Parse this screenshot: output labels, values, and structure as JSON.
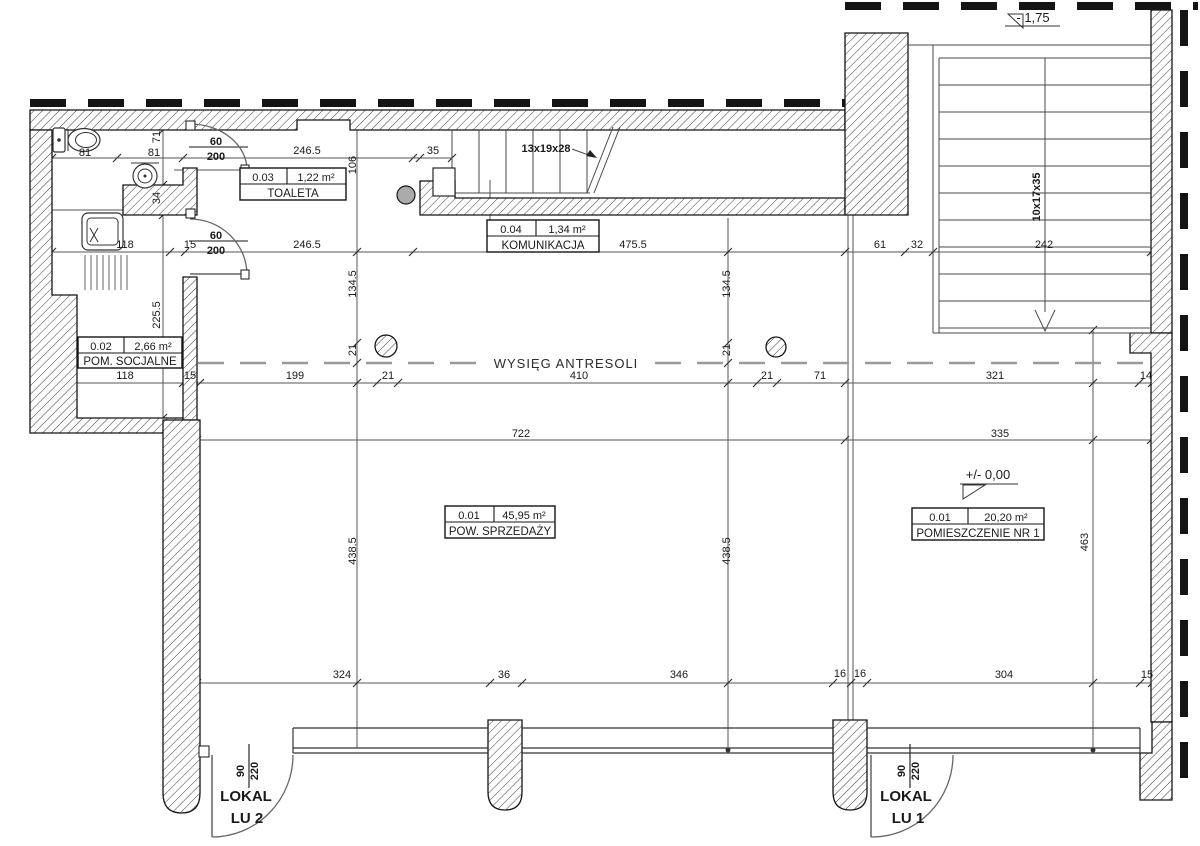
{
  "meta": {
    "drawing_type": "architectural floor plan"
  },
  "rooms": [
    {
      "number": "0.03",
      "area": "1,22 m²",
      "name": "TOALETA"
    },
    {
      "number": "0.04",
      "area": "1,34 m²",
      "name": "KOMUNIKACJA"
    },
    {
      "number": "0.02",
      "area": "2,66 m²",
      "name": "POM. SOCJALNE"
    },
    {
      "number": "0.01",
      "area": "45,95 m²",
      "name": "POW. SPRZEDAŻY"
    },
    {
      "number": "0.01",
      "area": "20,20 m²",
      "name": "POMIESZCZENIE NR 1"
    }
  ],
  "annotations": {
    "antresola": "WYSIĘG ANTRESOLI",
    "stair_top_label": "13x19x28",
    "stair_right_label": "10x17x35",
    "level_upper": "- 1,75",
    "level_ground": "+/- 0,00",
    "lokal2_line1": "LOKAL",
    "lokal2_line2": "LU 2",
    "lokal1_line1": "LOKAL",
    "lokal1_line2": "LU 1"
  },
  "dimensions": [
    {
      "t": "81",
      "x": 85,
      "y": 156
    },
    {
      "t": "81",
      "x": 154,
      "y": 156
    },
    {
      "t": "60",
      "x": 216,
      "y": 145,
      "b": 1
    },
    {
      "t": "200",
      "x": 216,
      "y": 160,
      "b": 1
    },
    {
      "t": "246.5",
      "x": 307,
      "y": 154
    },
    {
      "t": "35",
      "x": 433,
      "y": 154
    },
    {
      "t": "118",
      "x": 125,
      "y": 248
    },
    {
      "t": "15",
      "x": 190,
      "y": 248
    },
    {
      "t": "60",
      "x": 216,
      "y": 239,
      "b": 1
    },
    {
      "t": "200",
      "x": 216,
      "y": 254,
      "b": 1
    },
    {
      "t": "246.5",
      "x": 307,
      "y": 248
    },
    {
      "t": "475.5",
      "x": 633,
      "y": 248
    },
    {
      "t": "61",
      "x": 880,
      "y": 248
    },
    {
      "t": "32",
      "x": 917,
      "y": 248
    },
    {
      "t": "242",
      "x": 1044,
      "y": 248
    },
    {
      "t": "118",
      "x": 125,
      "y": 379
    },
    {
      "t": "15",
      "x": 190,
      "y": 379
    },
    {
      "t": "199",
      "x": 295,
      "y": 379
    },
    {
      "t": "21",
      "x": 388,
      "y": 379
    },
    {
      "t": "410",
      "x": 579,
      "y": 379
    },
    {
      "t": "21",
      "x": 767,
      "y": 379
    },
    {
      "t": "71",
      "x": 820,
      "y": 379
    },
    {
      "t": "321",
      "x": 995,
      "y": 379
    },
    {
      "t": "14",
      "x": 1146,
      "y": 379
    },
    {
      "t": "722",
      "x": 521,
      "y": 437
    },
    {
      "t": "335",
      "x": 1000,
      "y": 437
    },
    {
      "t": "324",
      "x": 342,
      "y": 678
    },
    {
      "t": "36",
      "x": 504,
      "y": 678
    },
    {
      "t": "346",
      "x": 679,
      "y": 678
    },
    {
      "t": "16",
      "x": 840,
      "y": 677
    },
    {
      "t": "16",
      "x": 860,
      "y": 677
    },
    {
      "t": "304",
      "x": 1004,
      "y": 678
    },
    {
      "t": "15",
      "x": 1147,
      "y": 678
    },
    {
      "t": "71",
      "x": 160,
      "y": 137,
      "r": -90
    },
    {
      "t": "106",
      "x": 356,
      "y": 165,
      "r": -90
    },
    {
      "t": "34",
      "x": 160,
      "y": 198,
      "r": -90
    },
    {
      "t": "225.5",
      "x": 160,
      "y": 315,
      "r": -90
    },
    {
      "t": "134.5",
      "x": 356,
      "y": 284,
      "r": -90
    },
    {
      "t": "134.5",
      "x": 730,
      "y": 284,
      "r": -90
    },
    {
      "t": "21",
      "x": 356,
      "y": 350,
      "r": -90
    },
    {
      "t": "21",
      "x": 730,
      "y": 350,
      "r": -90
    },
    {
      "t": "438.5",
      "x": 356,
      "y": 551,
      "r": -90
    },
    {
      "t": "438.5",
      "x": 730,
      "y": 551,
      "r": -90
    },
    {
      "t": "463",
      "x": 1088,
      "y": 542,
      "r": -90
    },
    {
      "t": "90",
      "x": 244,
      "y": 771,
      "r": -90,
      "b": 1
    },
    {
      "t": "220",
      "x": 258,
      "y": 771,
      "r": -90,
      "b": 1
    },
    {
      "t": "90",
      "x": 905,
      "y": 771,
      "r": -90,
      "b": 1
    },
    {
      "t": "220",
      "x": 919,
      "y": 771,
      "r": -90,
      "b": 1
    }
  ],
  "colors": {
    "line": "#141414",
    "thin_line": "#555555",
    "hatch": "#3c3c3c",
    "antresola_dash": "#9a9a9a",
    "background": "#ffffff"
  }
}
